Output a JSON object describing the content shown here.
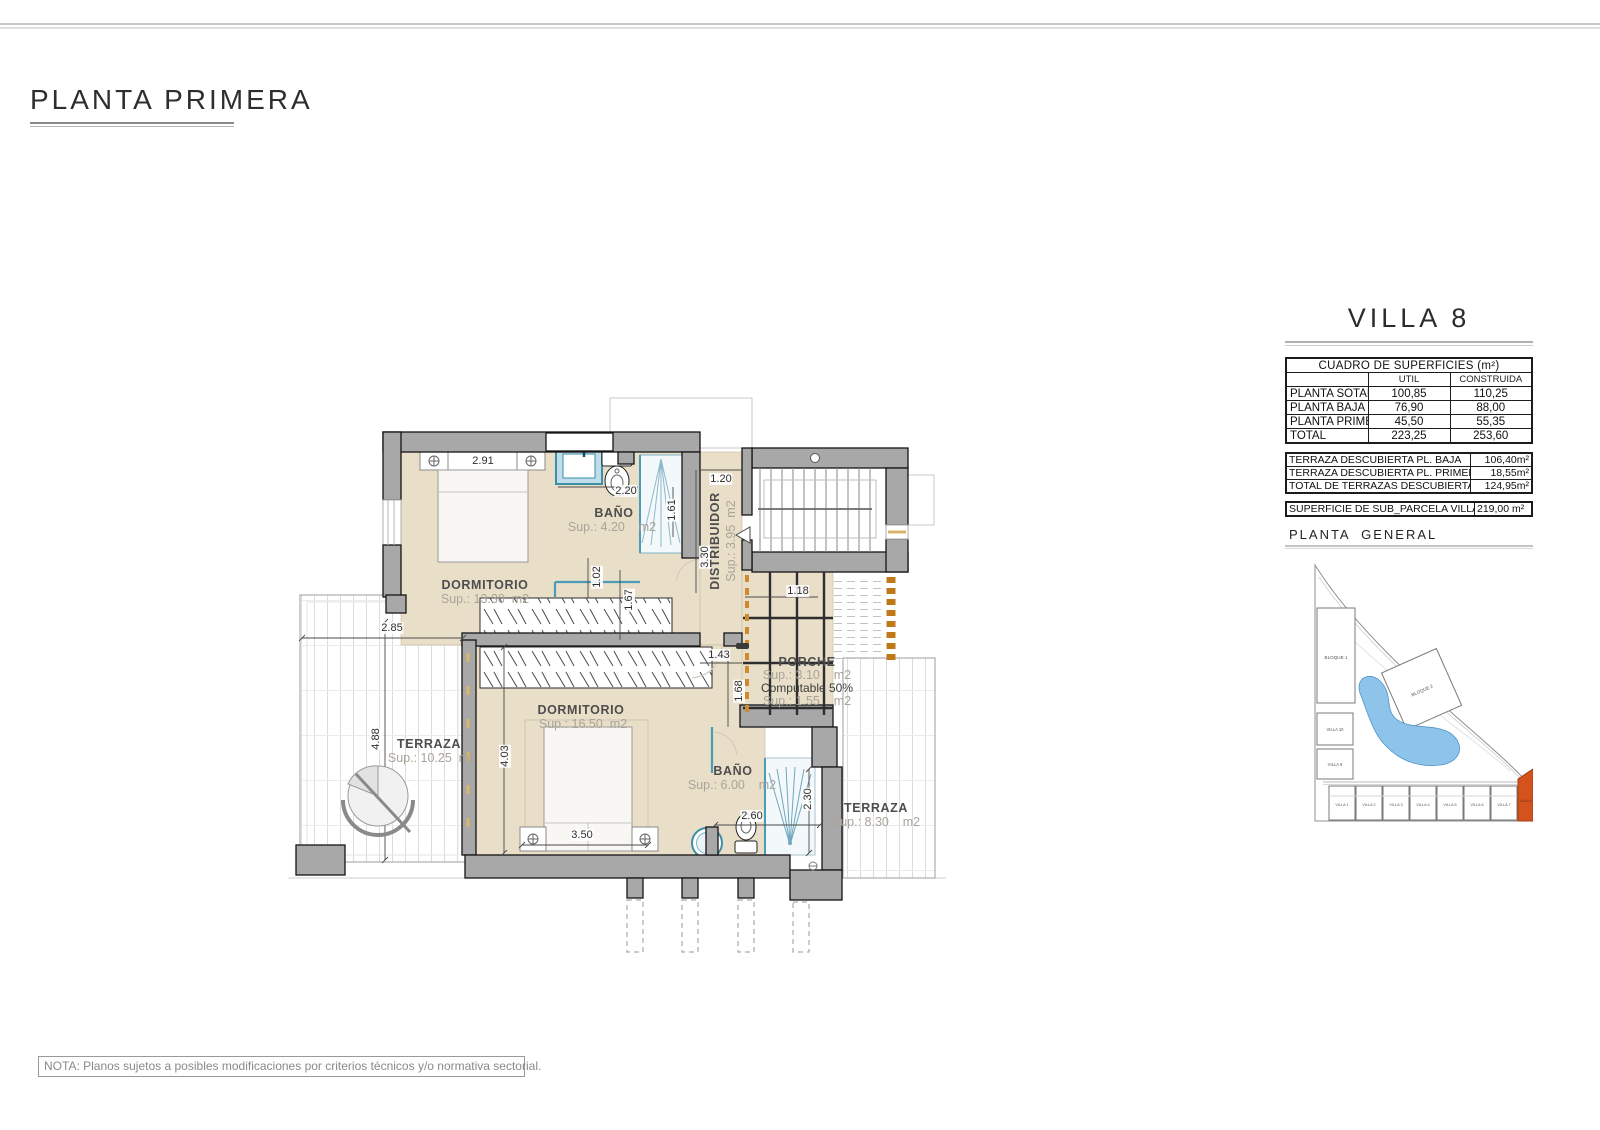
{
  "title": "PLANTA PRIMERA",
  "note": "NOTA: Planos sujetos a posibles modificaciones por criterios técnicos y/o normativa sectorial.",
  "plan": {
    "rooms": {
      "dormitorio1": {
        "name": "DORMITORIO",
        "sup": "Sup.: 13.30  m2"
      },
      "bano1": {
        "name": "BAÑO",
        "sup": "Sup.: 4.20    m2"
      },
      "distribuidor": {
        "name": "DISTRIBUIDOR",
        "sup": "Sup.: 3.95  m2"
      },
      "dormitorio2": {
        "name": "DORMITORIO",
        "sup": "Sup.: 16.50  m2"
      },
      "bano2": {
        "name": "BAÑO",
        "sup": "Sup.: 6.00    m2"
      },
      "terraza1": {
        "name": "TERRAZA",
        "sup": "Sup.: 10.25  m2"
      },
      "terraza2": {
        "name": "TERRAZA",
        "sup": "Sup.: 8.30    m2"
      },
      "porche": {
        "name": "PORCHE",
        "sup": "Sup.: 3.10    m2",
        "computable": "Computable 50%",
        "sup2": "Sup.: 1.55    m2"
      }
    },
    "dimensions": {
      "d291": "2.91",
      "d220": "2.20",
      "d120": "1.20",
      "d161": "1.61",
      "d330": "3.30",
      "d102": "1.02",
      "d167": "1.67",
      "d285": "2.85",
      "d488": "4.88",
      "d143": "1.43",
      "d118": "1.18",
      "d168": "1.68",
      "d403": "4.03",
      "d350": "3.50",
      "d260": "2.60",
      "d230": "2.30"
    }
  },
  "villa_panel": {
    "title": "VILLA 8",
    "surfaces": {
      "header": "CUADRO DE SUPERFICIES (m²)",
      "col_util": "UTIL",
      "col_construida": "CONSTRUIDA",
      "rows": [
        {
          "label": "PLANTA SOTANO",
          "util": "100,85",
          "construida": "110,25"
        },
        {
          "label": "PLANTA BAJA",
          "util": "76,90",
          "construida": "88,00"
        },
        {
          "label": "PLANTA PRIMERA",
          "util": "45,50",
          "construida": "55,35"
        },
        {
          "label": "TOTAL",
          "util": "223,25",
          "construida": "253,60"
        }
      ]
    },
    "terrazas": {
      "rows": [
        {
          "label": "TERRAZA DESCUBIERTA PL. BAJA",
          "value": "106,40m²"
        },
        {
          "label": "TERRAZA DESCUBIERTA PL. PRIMERA",
          "value": "18,55m²"
        },
        {
          "label": "TOTAL DE TERRAZAS DESCUBIERTAS",
          "value": "124,95m²"
        }
      ]
    },
    "parcela": {
      "label": "SUPERFICIE DE SUB_PARCELA VILLA 8",
      "value": "219,00 m²"
    },
    "general_label": "PLANTA  GENERAL",
    "siteplan": {
      "bloque1": "BLOQUE 1",
      "bloque2": "BLOQUE 2",
      "villa10": "VILLA 10",
      "villa9": "VILLA 9",
      "villas": [
        "VILLA 1",
        "VILLA 2",
        "VILLA 3",
        "VILLA 4",
        "VILLA 5",
        "VILLA 6",
        "VILLA 7",
        "VILLA 8"
      ]
    }
  },
  "colors": {
    "floor_beige": "#e9dfc9",
    "wall_gray": "#a8a8a8",
    "fixture_blue": "#3d8fa8",
    "window_tan": "#cf8a2e",
    "villa8_highlight": "#d4531c",
    "pool_blue": "#8fc4ea"
  }
}
